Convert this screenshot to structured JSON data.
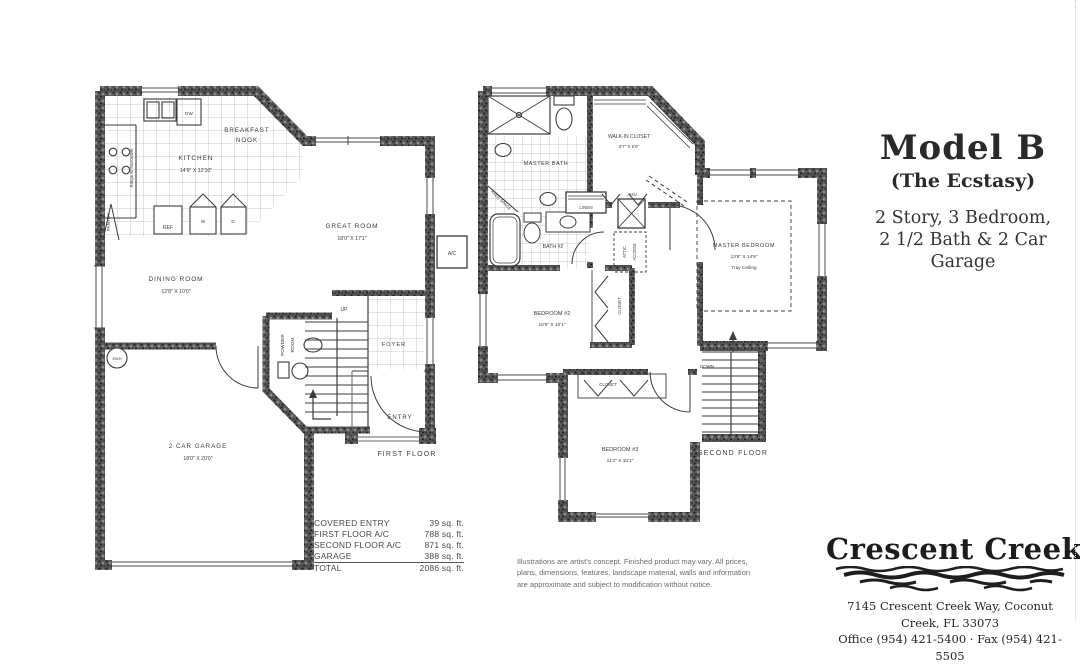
{
  "header": {
    "title": "Model B",
    "subtitle": "(The Ecstasy)",
    "desc1": "2 Story, 3 Bedroom,",
    "desc2": "2 1/2 Bath & 2 Car Garage"
  },
  "first_floor": {
    "caption": "FIRST FLOOR",
    "kitchen": {
      "name": "KITCHEN",
      "dims": "14'9\" X 12'10\""
    },
    "breakfast_nook": {
      "line1": "BREAKFAST",
      "line2": "NOOK"
    },
    "great_room": {
      "name": "GREAT ROOM",
      "dims": "18'0\" X 17'1\""
    },
    "dining_room": {
      "name": "DINING ROOM",
      "dims": "12'8\" X 10'0\""
    },
    "garage": {
      "name": "2 CAR GARAGE",
      "dims": "18'0\" X 20'0\""
    },
    "foyer": "FOYER",
    "entry": "ENTRY",
    "pantry": "PANTRY",
    "powder_room": {
      "line1": "POWDER",
      "line2": "ROOM"
    },
    "up": "UP",
    "range_note": "Range w/ Microwave",
    "appliances": {
      "dw": "DW",
      "ref": "REF",
      "washer": "W",
      "dryer": "D",
      "ewh": "EWH",
      "ac": "A/C"
    }
  },
  "second_floor": {
    "caption": "SECOND FLOOR",
    "master_bedroom": {
      "name": "MASTER BEDROOM",
      "dims": "13'6\" X 14'6\"",
      "note": "Tray Ceiling"
    },
    "master_bath": "MASTER BATH",
    "walk_in_closet": {
      "name": "WALK-IN CLOSET",
      "dims": "8'7\" X 5'0\""
    },
    "bath2": "BATH #2",
    "bedroom2": {
      "name": "BEDROOM #2",
      "dims": "10'6\" X 10'1\""
    },
    "bedroom3": {
      "name": "BEDROOM #3",
      "dims": "11'2\" X 10'1\""
    },
    "linen": "LINEN",
    "ahu": "AHU",
    "attic_access": {
      "line1": "ATTIC",
      "line2": "ACCESS"
    },
    "closet_bed2": "CLOSET",
    "closet_bed3": "CLOSET",
    "knee_space": "KNEE SPACE",
    "down": "DOWN"
  },
  "area_table": {
    "rows": [
      {
        "label": "COVERED ENTRY",
        "value": "39 sq. ft."
      },
      {
        "label": "FIRST FLOOR  A/C",
        "value": "788 sq. ft."
      },
      {
        "label": "SECOND FLOOR A/C",
        "value": "871 sq. ft."
      },
      {
        "label": "GARAGE",
        "value": "388 sq. ft."
      },
      {
        "label": "TOTAL",
        "value": "2086 sq. ft."
      }
    ]
  },
  "disclaimer": "Illustrations are artist's concept. Finished product may vary. All prices, plans, dimensions, features, landscape material, walls and information are approximate and subject to modification without notice.",
  "branding": {
    "logo_text": "Crescent Creek",
    "address": "7145 Crescent Creek Way, Coconut Creek, FL 33073",
    "phone": "Office (954) 421-5400 · Fax (954) 421-5505"
  },
  "colors": {
    "ink": "#3c3c3c",
    "wall": "#555555",
    "paper": "#ffffff"
  }
}
